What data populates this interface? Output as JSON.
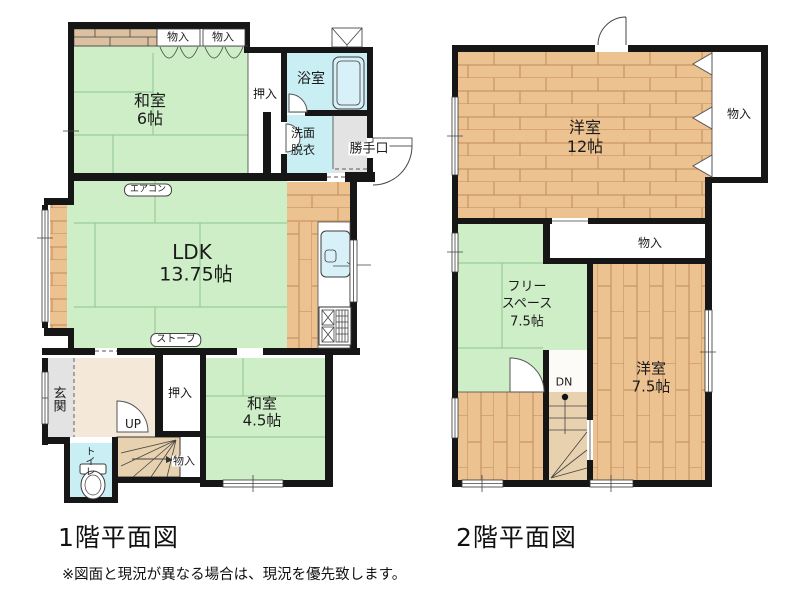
{
  "colors": {
    "wall": "#161616",
    "tatami": "#cdeec6",
    "tatami_line": "#8fc48f",
    "wood": "#edc291",
    "wood_line": "#c08a58",
    "water": "#c9eef3",
    "fixture": "#d8f1f8",
    "gray": "#e3e3e3",
    "hall": "#f4e9d9",
    "stair": "#e8d1af",
    "line": "#444444",
    "strip": "#dcc1a1",
    "text": "#1b1b1b"
  },
  "floor1": {
    "title": "1階平面図",
    "rooms": {
      "washitsu6": {
        "name": "和室",
        "size": "6帖"
      },
      "ldk": {
        "name": "LDK",
        "size": "13.75帖"
      },
      "washitsu45": {
        "name": "和室",
        "size": "4.5帖"
      },
      "bathroom": "浴室",
      "washroom_line1": "洗面",
      "washroom_line2": "脱衣",
      "backdoor": "勝手口",
      "genkan": "玄関",
      "toilet": "トイレ",
      "closet_top": "押入",
      "closet_bottom": "押入",
      "storage_a": "物入",
      "storage_b": "物入",
      "storage_stairs": "物入",
      "aircon": "エアコン",
      "stove": "ストーブ",
      "up": "UP"
    }
  },
  "floor2": {
    "title": "2階平面図",
    "rooms": {
      "yoshitsu12": {
        "name": "洋室",
        "size": "12帖"
      },
      "yoshitsu75": {
        "name": "洋室",
        "size": "7.5帖"
      },
      "freespace": {
        "line1": "フリー",
        "line2": "スペース",
        "size": "7.5帖"
      },
      "storage_right": "物入",
      "storage_mid": "物入",
      "dn": "DN"
    }
  },
  "note": "※図面と現況が異なる場合は、現況を優先致します。"
}
